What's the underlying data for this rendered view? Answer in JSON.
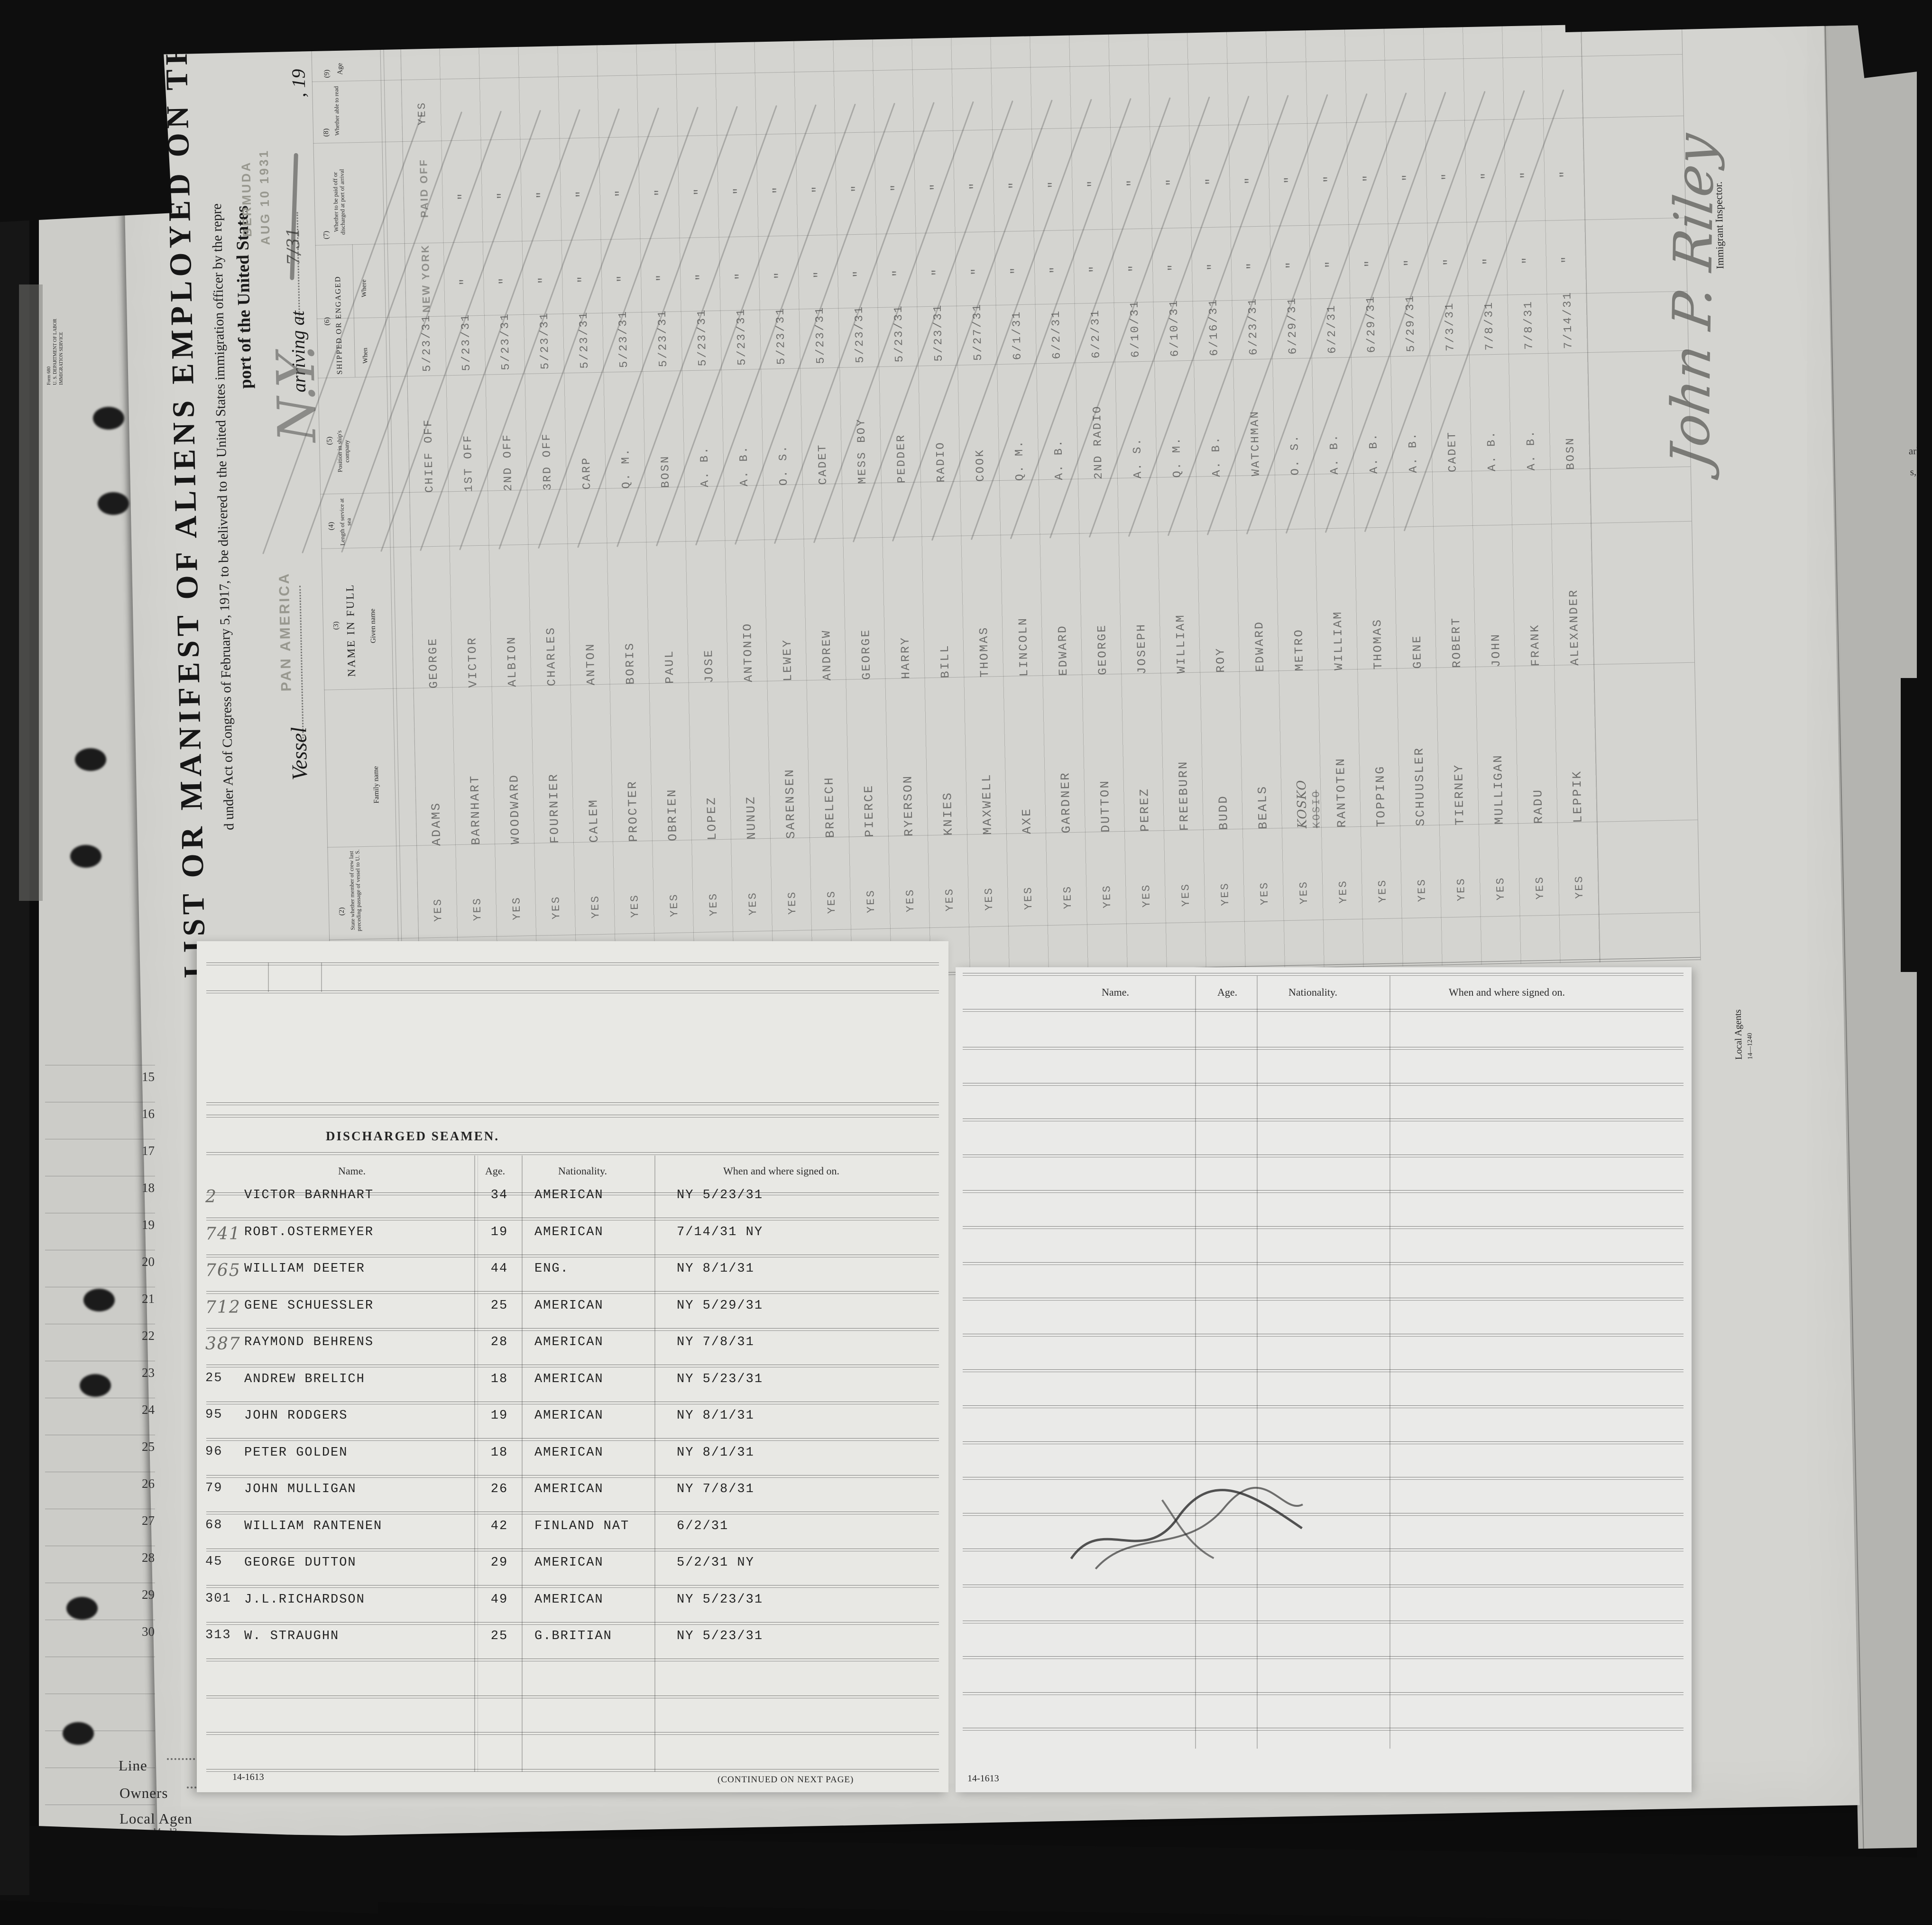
{
  "manifest": {
    "title": "LIST OR MANIFEST OF ALIENS EMPLOYED ON THE VESSEL",
    "act_line": "d under Act of Congress of February 5, 1917, to be delivered to the United States immigration officer by the repre",
    "port_line": "port of the United States",
    "vessel_label": "Vessel",
    "vessel_name_stamp": "PAN AMERICA",
    "arriving_label": "arriving at",
    "year_fragment": ", 19",
    "port_stamp": {
      "line1": "BERMUDA",
      "line2": "AUG 10 1931"
    },
    "pencil_notes": {
      "top_left": "Crew 2 of 2",
      "ny": "N.Y.",
      "date": "7/31"
    },
    "form_corner": {
      "l1": "Form 680",
      "l2": "U. S. DEPARTMENT OF LABOR",
      "l3": "IMMIGRATION SERVICE"
    },
    "columns": {
      "c2": {
        "no": "(2)",
        "label": "State whether member of crew last preceding passage of vessel to U. S."
      },
      "c3": {
        "no": "(3)",
        "label": "NAME IN FULL",
        "family": "Family name",
        "given": "Given name"
      },
      "c4": {
        "no": "(4)",
        "label": "Length of service at sea"
      },
      "c5": {
        "no": "(5)",
        "label": "Position in ship's company"
      },
      "c6": {
        "no": "(6)",
        "label": "SHIPPED OR ENGAGED",
        "when": "When",
        "where": "Where"
      },
      "c7": {
        "no": "(7)",
        "label": "Whether to be paid off or discharged at port of arrival"
      },
      "c8": {
        "no": "(8)",
        "label": "Whether able to read"
      },
      "c9": {
        "no": "(9)",
        "label": "Age"
      }
    },
    "member_yes": "YES",
    "first_where": "NEW YORK",
    "first_paid": "PAID OFF",
    "ditto_mark": "\"",
    "row_number_fragment": "240",
    "crew": [
      {
        "f": "ADAMS",
        "g": "GEORGE",
        "p": "CHIEF OFF",
        "w": "5/23/31",
        "a": ""
      },
      {
        "f": "BARNHART",
        "g": "VICTOR",
        "p": "1ST OFF",
        "w": "5/23/31",
        "a": ""
      },
      {
        "f": "WOODWARD",
        "g": "ALBION",
        "p": "2ND OFF",
        "w": "5/23/31",
        "a": ""
      },
      {
        "f": "FOURNIER",
        "g": "CHARLES",
        "p": "3RD OFF",
        "w": "5/23/31",
        "a": ""
      },
      {
        "f": "CALEM",
        "g": "ANTON",
        "p": "CARP",
        "w": "5/23/31",
        "a": ""
      },
      {
        "f": "PROCTER",
        "g": "BORIS",
        "p": "Q. M.",
        "w": "5/23/31",
        "a": ""
      },
      {
        "f": "OBRIEN",
        "g": "PAUL",
        "p": "BOSN",
        "w": "5/23/31",
        "a": ""
      },
      {
        "f": "LOPEZ",
        "g": "JOSE",
        "p": "A. B.",
        "w": "5/23/31",
        "a": ""
      },
      {
        "f": "NUNUZ",
        "g": "ANTONIO",
        "p": "A. B.",
        "w": "5/23/31",
        "a": ""
      },
      {
        "f": "SARENSEN",
        "g": "LEWEY",
        "p": "O. S.",
        "w": "5/23/31",
        "a": "30"
      },
      {
        "f": "BRELECH",
        "g": "ANDREW",
        "p": "CADET",
        "w": "5/23/31",
        "a": "22"
      },
      {
        "f": "PIERCE",
        "g": "GEORGE",
        "p": "MESS BOY",
        "w": "5/23/31",
        "a": "44"
      },
      {
        "f": "RYERSON",
        "g": "HARRY",
        "p": "PEDDER",
        "w": "5/23/31",
        "a": "25"
      },
      {
        "f": "KNIES",
        "g": "BILL",
        "p": "RADIO",
        "w": "5/23/31",
        "a": "20"
      },
      {
        "f": "MAXWELL",
        "g": "THOMAS",
        "p": "COOK",
        "w": "5/27/31",
        "a": "25"
      },
      {
        "f": "AXE",
        "g": "LINCOLN",
        "p": "Q. M.",
        "w": "6/1/31",
        "a": "40"
      },
      {
        "f": "GARDNER",
        "g": "EDWARD",
        "p": "A. B.",
        "w": "6/2/31",
        "a": "22"
      },
      {
        "f": "DUTTON",
        "g": "GEORGE",
        "p": "2ND RADIO",
        "w": "6/2/31",
        "a": "42"
      },
      {
        "f": "PEREZ",
        "g": "JOSEPH",
        "p": "A. S.",
        "w": "6/10/31",
        "a": "46"
      },
      {
        "f": "FREEBURN",
        "g": "WILLIAM",
        "p": "Q. M.",
        "w": "6/10/31",
        "a": "18"
      },
      {
        "f": "BUDD",
        "g": "ROY",
        "p": "A. B.",
        "w": "6/16/31",
        "a": "30"
      },
      {
        "f": "BEALS",
        "g": "EDWARD",
        "p": "WATCHMAN",
        "w": "6/23/31",
        "a": "22"
      },
      {
        "f": "KOSKO",
        "fs": "KOSIO",
        "hand": true,
        "g": "METRO",
        "p": "O. S.",
        "w": "6/29/31",
        "a": "24"
      },
      {
        "f": "RANTOTEN",
        "g": "WILLIAM",
        "p": "A. B.",
        "w": "6/2/31",
        "a": "20"
      },
      {
        "f": "TOPPING",
        "g": "THOMAS",
        "p": "A. B.",
        "w": "6/29/31",
        "a": "28"
      },
      {
        "f": "SCHUUSLER",
        "g": "GENE",
        "p": "A. B.",
        "w": "5/29/31",
        "a": "26"
      },
      {
        "f": "TIERNEY",
        "g": "ROBERT",
        "p": "CADET",
        "w": "7/3/31",
        "a": "31"
      },
      {
        "f": "MULLIGAN",
        "g": "JOHN",
        "p": "A. B.",
        "w": "7/8/31",
        "a": ""
      },
      {
        "f": "RADU",
        "g": "FRANK",
        "p": "A. B.",
        "w": "7/8/31",
        "a": ""
      },
      {
        "f": "LEPPIK",
        "g": "ALEXANDER",
        "p": "BOSN",
        "w": "7/14/31",
        "a": ""
      }
    ],
    "signature": "John P. Riley",
    "inspector_label": "Immigrant Inspector.",
    "local_agents": {
      "label": "Local Agents",
      "no": "14—1240"
    }
  },
  "overlay": {
    "discharged_title": "DISCHARGED SEAMEN.",
    "headers": {
      "name": "Name.",
      "age": "Age.",
      "nationality": "Nationality.",
      "signed": "When and where signed on."
    },
    "rows": [
      {
        "no": "2",
        "pencil": true,
        "name": "VICTOR BARNHART",
        "age": "34",
        "nat": "AMERICAN",
        "signed": "NY 5/23/31"
      },
      {
        "no": "741",
        "pencil": true,
        "name": "ROBT.OSTERMEYER",
        "age": "19",
        "nat": "AMERICAN",
        "signed": "7/14/31  NY"
      },
      {
        "no": "765",
        "pencil": true,
        "name": "WILLIAM DEETER",
        "age": "44",
        "nat": "ENG.",
        "signed": "NY  8/1/31"
      },
      {
        "no": "712",
        "pencil": true,
        "name": "GENE SCHUESSLER",
        "age": "25",
        "nat": "AMERICAN",
        "signed": "NY 5/29/31"
      },
      {
        "no": "387",
        "pencil": true,
        "name": "RAYMOND BEHRENS",
        "age": "28",
        "nat": "AMERICAN",
        "signed": "NY 7/8/31"
      },
      {
        "no": "25",
        "pencil": false,
        "name": "ANDREW BRELICH",
        "age": "18",
        "nat": "AMERICAN",
        "signed": "NY 5/23/31"
      },
      {
        "no": "95",
        "pencil": false,
        "name": "JOHN RODGERS",
        "age": "19",
        "nat": "AMERICAN",
        "signed": "NY 8/1/31"
      },
      {
        "no": "96",
        "pencil": false,
        "name": "PETER GOLDEN",
        "age": "18",
        "nat": "AMERICAN",
        "signed": "NY 8/1/31"
      },
      {
        "no": "79",
        "pencil": false,
        "name": "JOHN MULLIGAN",
        "age": "26",
        "nat": "AMERICAN",
        "signed": "NY 7/8/31"
      },
      {
        "no": "68",
        "pencil": false,
        "name": "WILLIAM RANTENEN",
        "age": "42",
        "nat": "FINLAND NAT",
        "signed": "6/2/31"
      },
      {
        "no": "45",
        "pencil": false,
        "name": "GEORGE DUTTON",
        "age": "29",
        "nat": "AMERICAN",
        "signed": "5/2/31  NY"
      },
      {
        "no": "301",
        "pencil": false,
        "name": "J.L.RICHARDSON",
        "age": "49",
        "nat": "AMERICAN",
        "signed": "NY 5/23/31"
      },
      {
        "no": "313",
        "pencil": false,
        "name": "W. STRAUGHN",
        "age": "25",
        "nat": "G.BRITIAN",
        "signed": "NY 5/23/31"
      }
    ],
    "form_no": "14-1613",
    "continued": "(CONTINUED ON NEXT PAGE)",
    "right_form_no": "14-1613"
  },
  "margin_line_numbers": [
    "15",
    "16",
    "17",
    "18",
    "19",
    "20",
    "21",
    "22",
    "23",
    "24",
    "25",
    "26",
    "27",
    "28",
    "29",
    "30"
  ],
  "footer_labels": {
    "line": "Line",
    "owners": "Owners",
    "local_agent": "Local Agen",
    "small_no": "14—12"
  },
  "edge_fragments": {
    "a": "a",
    "f1": "arks",
    "f2": "s, or",
    "f3": "s (2), (5), (6) and (7) is",
    "f4": "er side)"
  }
}
